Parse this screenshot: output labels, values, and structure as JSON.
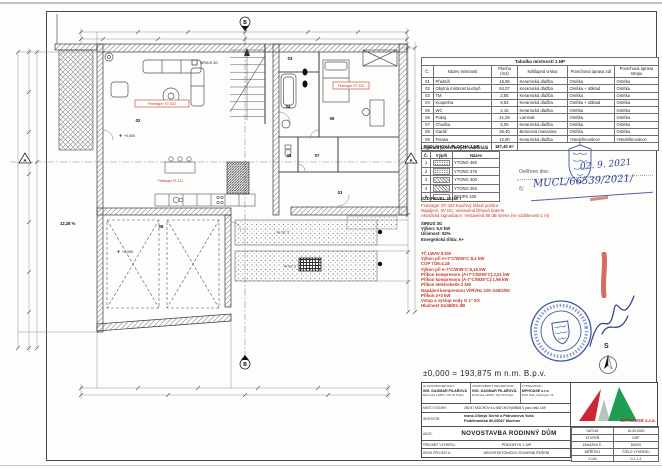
{
  "plan": {
    "section_a": "A",
    "section_b": "B",
    "rooms": {
      "r01": "01",
      "r02": "02",
      "r03": "03",
      "r04": "04",
      "r05": "05",
      "r06": "06",
      "r07": "07",
      "r08": "08"
    },
    "level_marker": "+0,000",
    "garage_slope": "12,28 %",
    "driveway_slope": "1,75 %",
    "smoke_detector": "Firetrager ST-422",
    "stove_label": "SIRIUS 3G"
  },
  "room_table": {
    "title": "Tabulka místností 1.NP",
    "headers": [
      "Č.",
      "Název místnosti",
      "Plocha (m2)",
      "Nášlapná vrstva",
      "Povrchová úprava zdí",
      "Povrchová úprava stropu"
    ],
    "rows": [
      [
        "01",
        "Předsíň",
        "16,89",
        "Keramická dlažba",
        "Omítka",
        "Omítka"
      ],
      [
        "02",
        "Obytná místnost kuchyň",
        "64,07",
        "Keramická dlažba",
        "Omítka + obklad",
        "Omítka"
      ],
      [
        "03",
        "TM",
        "2,55",
        "Keramická dlažba",
        "Omítka",
        "Omítka"
      ],
      [
        "04",
        "Koupelna",
        "8,54",
        "Keramická dlažba",
        "Omítka + obklad",
        "Omítka"
      ],
      [
        "05",
        "WC",
        "2,16",
        "Keramická dlažba",
        "Omítka",
        "Omítka"
      ],
      [
        "06",
        "Pokoj",
        "21,29",
        "Laminát",
        "Omítka",
        "Omítka"
      ],
      [
        "07",
        "Chodba",
        "5,05",
        "Keramická dlažba",
        "Omítka",
        "Omítka"
      ],
      [
        "08",
        "Garáž",
        "35,40",
        "Betonová mazanina",
        "Omítka",
        "Omítka"
      ],
      [
        "09",
        "Terasa",
        "12,80",
        "Keramická dlažba",
        "<Nedefinováno>",
        "<Nedefinováno>"
      ]
    ],
    "footer_label": "PODLAHOVÁ PLOCHA 1.NP:",
    "footer_value": "187,40 m²"
  },
  "legend": {
    "title": "Legenda povrchových materiálů",
    "headers": [
      "Č.",
      "Výplň",
      "Název"
    ],
    "rows": [
      {
        "num": "1",
        "fill": "dots",
        "name": "YTONG 450"
      },
      {
        "num": "2",
        "fill": "dots",
        "name": "YTONG 375"
      },
      {
        "num": "3",
        "fill": "diag",
        "name": "YTONG 300"
      },
      {
        "num": "4",
        "fill": "diag",
        "name": "YTONG 250"
      },
      {
        "num": "5",
        "fill": "blank",
        "name": "RIGIPS 100"
      }
    ]
  },
  "notes": {
    "dzd": "DZD REVEL 2x160 l",
    "detector_lines": [
      "Firetrager ST-422 Kouřový hlásič požáru",
      "Napájení: 9V DC, vestavěná lithiová baterie",
      "Akustická signalizace: Vestavěná 85 dB siréna (ve vzdálenosti 1 m)"
    ],
    "stove_lines": [
      "SIRIUS 3G",
      "Výkon: 5,0 kW",
      "Účinnost: 92%",
      "Energetická třída: A+"
    ],
    "heatpump_lines": [
      "TČ LWAV 8 kW",
      "Výkon při A+7°C/W35°C:8,4 kW",
      "COP 7/35:4,18",
      "Výkon při A-7°C/W35°C:6,16 kW",
      "Příkon kompresoru (A+7°C/W35°C):2,01 kW",
      "Příkon kompresoru (A-7°C/W35°C):1,96 kW",
      "Příkon elektrokotle 2 kW",
      "Napájení kompresoru V/Ph/Hz 220~240/2/50",
      "Příkon 2+3 kW",
      "Vstup a výstup vody G 1\" EX",
      "Hlučnost 51/48/Dn dB"
    ]
  },
  "stamp_area": {
    "verified_label": "Ověřeno dne:",
    "verified_date": "02. 9. 2021",
    "ref_label": "čj:",
    "ref_number": "MUCL/66539/2021/",
    "north_label": "S"
  },
  "elevation": "±0,000 = 193,875 m n.m. B.p.v.",
  "title_block": {
    "col1": {
      "label": "HLAVNÍ PROJEKTANT:",
      "name": "ING. DAGMAR PILAŘOVÁ",
      "address": "Berlínská 1485/5, 102 00 Praha"
    },
    "col2": {
      "label": "ZODPOVĚDNÝ PROJEKTANT:",
      "name": "ING. DAGMAR PILAŘOVÁ",
      "address": "Berlínská 1485/5, 102 00 Praha"
    },
    "col3": {
      "label": "VYPRACOVAL:",
      "name": "SIPHOUSE s.r.o.",
      "address": "5025 Dubí, Fatehlyan 78"
    },
    "misto_label": "MÍSTO STAVBY:",
    "misto_value": "250 87 MOCHOV k.ú.MOCHOV(698087) parc.číslo 169",
    "investor_label": "INVESTOR:",
    "investor_line1": "manž.Oliinyk Serhii a Patrusheva Yulia",
    "investor_line2": "Poděbradská 80,25087 Mochov",
    "akce_label": "AKCE:",
    "akce_value": "NOVOSTAVBA RODINNÝ DŮM",
    "predmet_label": "PŘEDMĚT VÝKRESU:",
    "predmet_value": "PŮDORYS 1.NP",
    "druh_label": "DRUH PROJEKTU:",
    "druh_value": "ARCHITEKTONICKO-STAVEBNÍ ŘEŠENÍ",
    "logo_text": "SIPHOUSE s.r.o.",
    "meta_rows": [
      [
        "DATUM",
        "15.09.2020"
      ],
      [
        "STUPEŇ",
        "DSP"
      ],
      [
        "ZAKÁZKA Č.",
        "5/2020"
      ],
      [
        "MĚŘÍTKO",
        "ČÍSLO VÝKRESU"
      ],
      [
        "1:100",
        "D.1.1.2"
      ]
    ]
  }
}
